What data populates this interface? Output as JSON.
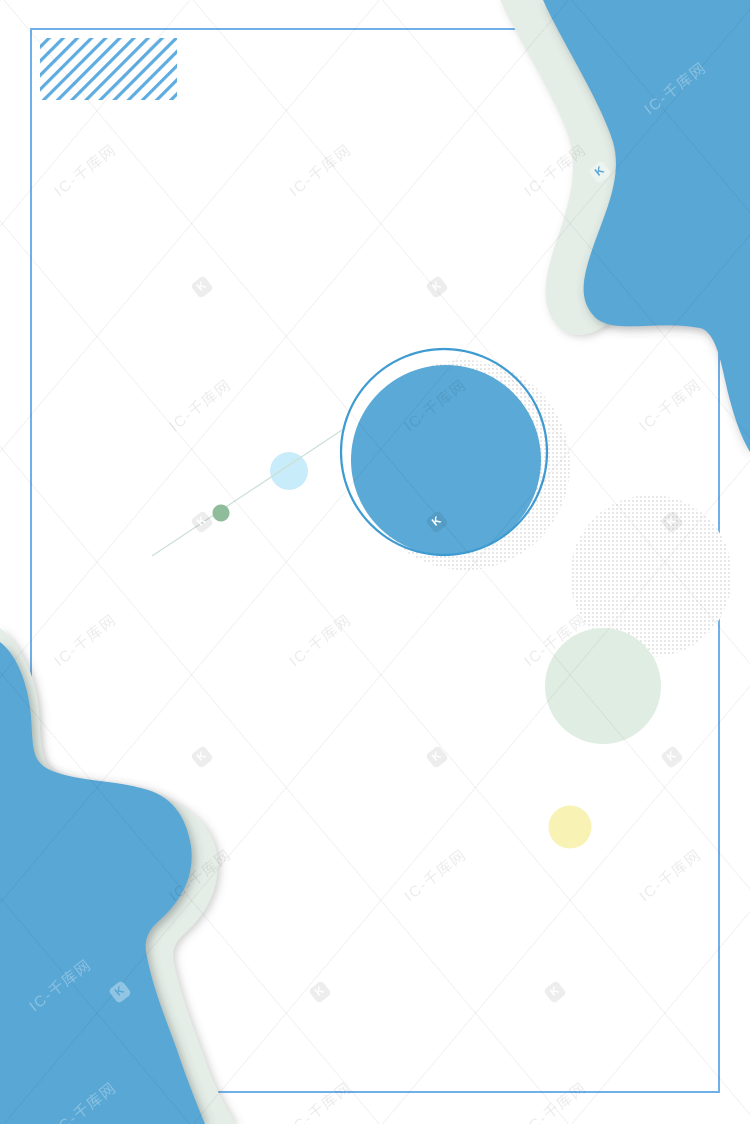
{
  "artwork": {
    "kind": "poster-background",
    "visible_text_only": "watermarks"
  },
  "colors": {
    "blue": "#58A7D5",
    "circle_blue": "#5AA9D7",
    "ring": "#3E9BD1",
    "frame": "#6FB0E8",
    "hatch": "#5FACE0",
    "sage": "#E4EEE7",
    "sage_circle": "#DFEDE3",
    "dot": "#D8D8D8",
    "pale_blue": "#C9ECFA",
    "green_dot": "#8FBC9B",
    "yellow": "#F8F2B4",
    "connector": "#CBDFD3",
    "wm_dark": "rgba(0,0,0,0.08)",
    "wm_light": "rgba(255,255,255,0.30)",
    "wm_line": "rgba(0,0,0,0.05)",
    "wm_box_dark": "rgba(0,0,0,0.07)",
    "wm_box_light": "rgba(255,255,255,0.35)"
  },
  "watermark": {
    "text": "IC-千库网",
    "logo_letter": "K",
    "instances": [
      {
        "type": "text",
        "x": 85,
        "y": 170,
        "tone": "dark"
      },
      {
        "type": "text",
        "x": 320,
        "y": 170,
        "tone": "dark"
      },
      {
        "type": "text",
        "x": 555,
        "y": 170,
        "tone": "dark"
      },
      {
        "type": "text",
        "x": 675,
        "y": 88,
        "tone": "light"
      },
      {
        "type": "text",
        "x": 200,
        "y": 405,
        "tone": "dark"
      },
      {
        "type": "text",
        "x": 435,
        "y": 405,
        "tone": "dark"
      },
      {
        "type": "text",
        "x": 670,
        "y": 405,
        "tone": "dark"
      },
      {
        "type": "text",
        "x": 85,
        "y": 640,
        "tone": "dark"
      },
      {
        "type": "text",
        "x": 320,
        "y": 640,
        "tone": "dark"
      },
      {
        "type": "text",
        "x": 555,
        "y": 640,
        "tone": "dark"
      },
      {
        "type": "text",
        "x": 200,
        "y": 875,
        "tone": "dark"
      },
      {
        "type": "text",
        "x": 435,
        "y": 875,
        "tone": "dark"
      },
      {
        "type": "text",
        "x": 670,
        "y": 875,
        "tone": "dark"
      },
      {
        "type": "text",
        "x": 60,
        "y": 985,
        "tone": "light"
      },
      {
        "type": "text",
        "x": 85,
        "y": 1108,
        "tone": "light"
      },
      {
        "type": "text",
        "x": 320,
        "y": 1108,
        "tone": "dark"
      },
      {
        "type": "text",
        "x": 555,
        "y": 1108,
        "tone": "dark"
      },
      {
        "type": "logo",
        "x": 202,
        "y": 287,
        "tone": "dark"
      },
      {
        "type": "logo",
        "x": 437,
        "y": 287,
        "tone": "dark"
      },
      {
        "type": "logo",
        "x": 600,
        "y": 172,
        "tone": "light"
      },
      {
        "type": "logo",
        "x": 202,
        "y": 522,
        "tone": "dark"
      },
      {
        "type": "logo",
        "x": 437,
        "y": 522,
        "tone": "dark"
      },
      {
        "type": "logo",
        "x": 672,
        "y": 522,
        "tone": "dark"
      },
      {
        "type": "logo",
        "x": 202,
        "y": 757,
        "tone": "dark"
      },
      {
        "type": "logo",
        "x": 437,
        "y": 757,
        "tone": "dark"
      },
      {
        "type": "logo",
        "x": 672,
        "y": 757,
        "tone": "dark"
      },
      {
        "type": "logo",
        "x": 120,
        "y": 992,
        "tone": "light"
      },
      {
        "type": "logo",
        "x": 320,
        "y": 992,
        "tone": "dark"
      },
      {
        "type": "logo",
        "x": 555,
        "y": 992,
        "tone": "dark"
      }
    ]
  }
}
